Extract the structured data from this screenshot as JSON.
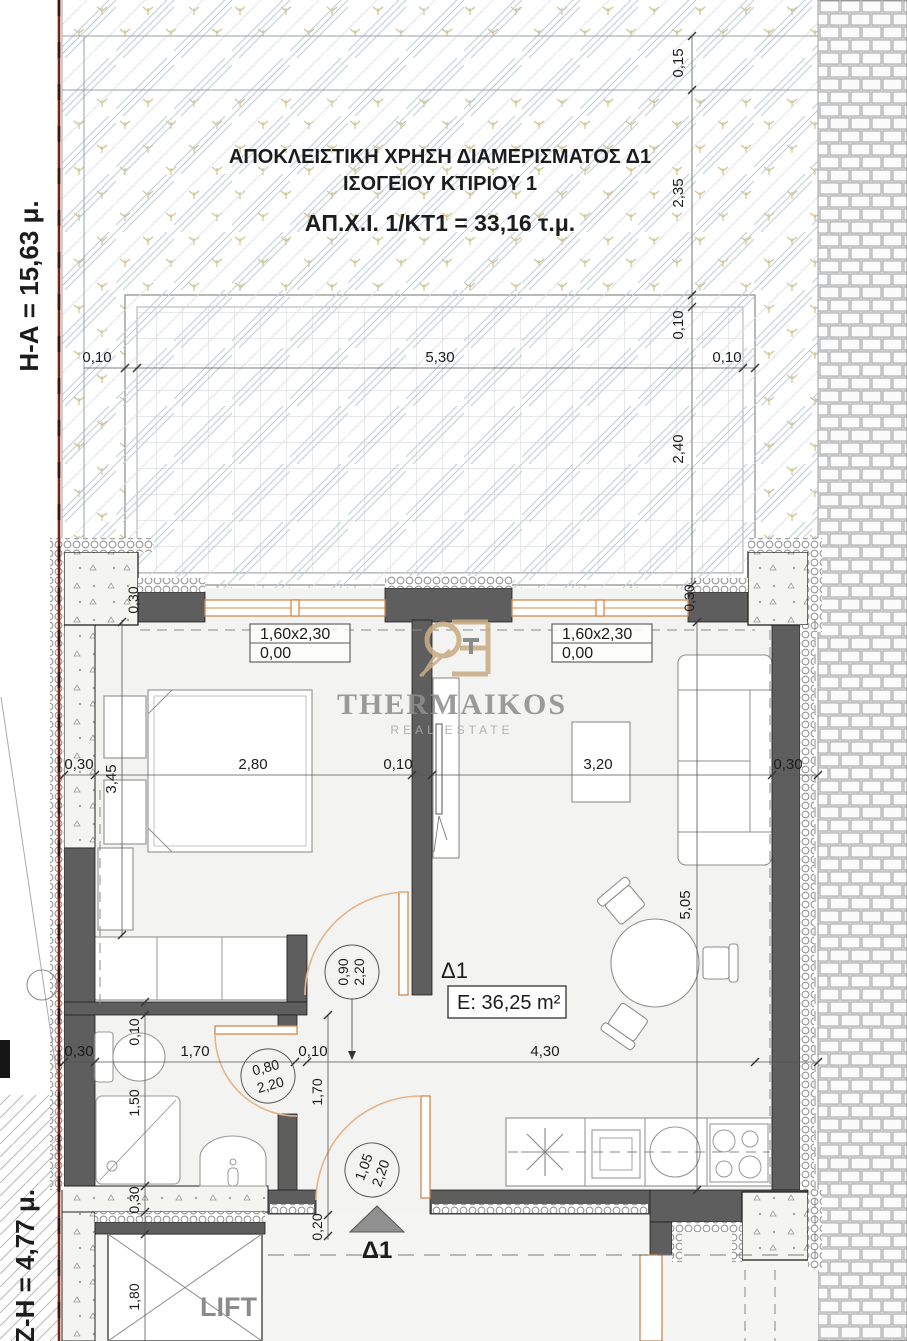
{
  "side_labels": {
    "top": "Η-Α = 15,63 μ.",
    "bottom": "Ζ-Η = 4,77 μ."
  },
  "courtyard": {
    "line1": "ΑΠΟΚΛΕΙΣΤΙΚΗ ΧΡΗΣΗ ΔΙΑΜΕΡΙΣΜΑΤΟΣ Δ1",
    "line2": "ΙΣΟΓΕΙΟΥ ΚΤΙΡΙΟΥ 1",
    "line3": "ΑΠ.Χ.Ι. 1/ΚΤ1 = 33,16 τ.μ."
  },
  "unit": {
    "id": "Δ1",
    "area": "E: 36,25 m²"
  },
  "window_label": {
    "size": "1,60x2,30",
    "sill": "0,00"
  },
  "door_labels": {
    "bedroom_w": "0,90",
    "bathroom_w": "0,80",
    "entrance_w": "1,05",
    "h": "2,20"
  },
  "dims": {
    "d010": "0,10",
    "d015": "0,15",
    "d020": "0,20",
    "d030": "0,30",
    "d150": "1,50",
    "d170": "1,70",
    "d180": "1,80",
    "d235": "2,35",
    "d240": "2,40",
    "d280": "2,80",
    "d320": "3,20",
    "d345": "3,45",
    "d430": "4,30",
    "d505": "5,05",
    "d530": "5,30"
  },
  "lift_label": "LIFT",
  "entrance": {
    "unit": "Δ1"
  },
  "logo": {
    "name": "THERMAIKOS",
    "tagline": "REAL ESTATE"
  },
  "colors": {
    "wall": "#5e5e5e",
    "window_frame": "#cf8a4e",
    "door_arc": "#e6b489",
    "boundary_red": "#7a2014",
    "hatch_green": "#cdc48e",
    "hatch_blue": "#c2cdd8",
    "logo_gold": "#c9ad84",
    "logo_gray": "#8e8e8e"
  }
}
